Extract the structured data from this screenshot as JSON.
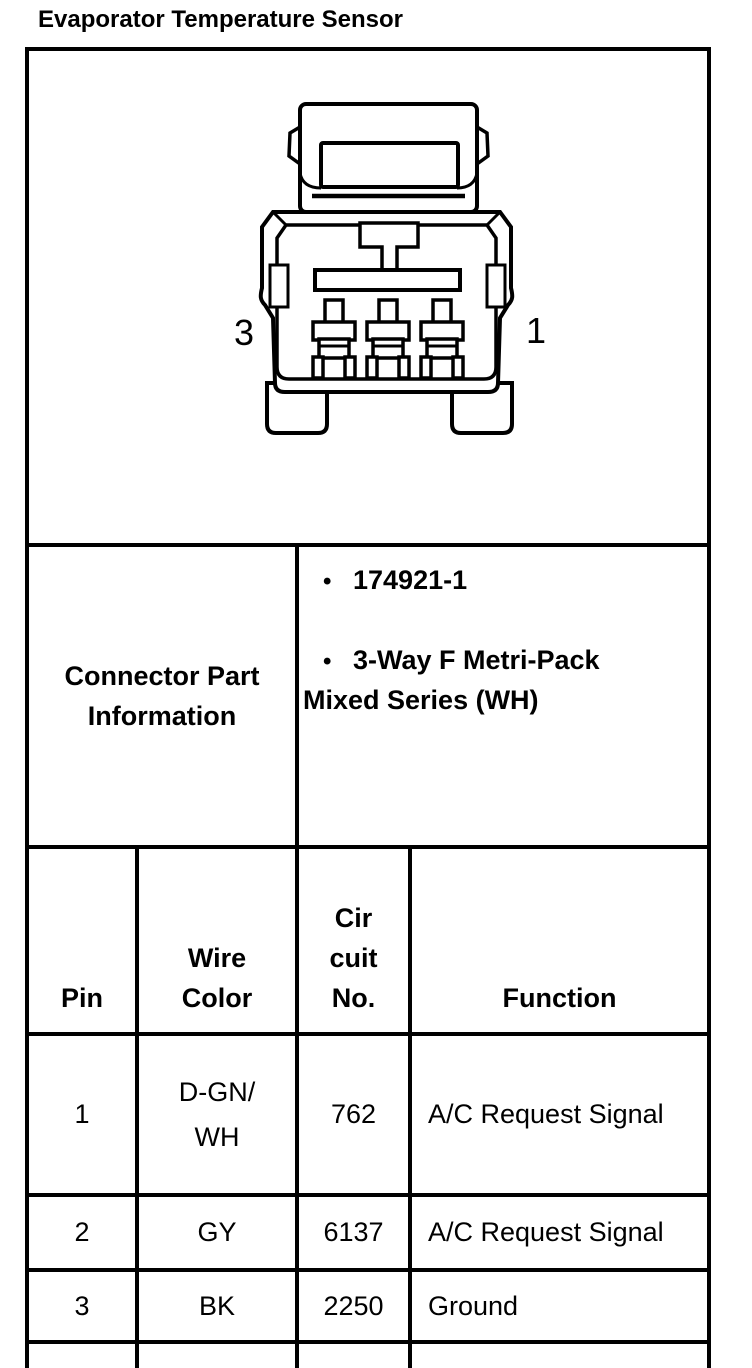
{
  "page": {
    "title": "Evaporator Temperature Sensor"
  },
  "diagram": {
    "description": "3-way connector face view",
    "pin_label_left": "3",
    "pin_label_right": "1"
  },
  "part_info": {
    "label": "Connector Part\nInformation",
    "items": [
      {
        "marker": "•",
        "text": "174921-1"
      },
      {
        "marker": "•",
        "text": "3-Way F Metri-Pack\nMixed Series (WH)"
      }
    ]
  },
  "pin_table": {
    "headers": [
      "Pin",
      "Wire\nColor",
      "Cir\ncuit\nNo.",
      "Function"
    ],
    "rows": [
      {
        "pin": "1",
        "wire_color": "D-GN/\nWH",
        "circuit_no": "762",
        "function": "A/C Request Signal"
      },
      {
        "pin": "2",
        "wire_color": "GY",
        "circuit_no": "6137",
        "function": "A/C Request Signal"
      },
      {
        "pin": "3",
        "wire_color": "BK",
        "circuit_no": "2250",
        "function": "Ground"
      }
    ]
  },
  "colors": {
    "line": "#000000",
    "background": "#ffffff"
  }
}
